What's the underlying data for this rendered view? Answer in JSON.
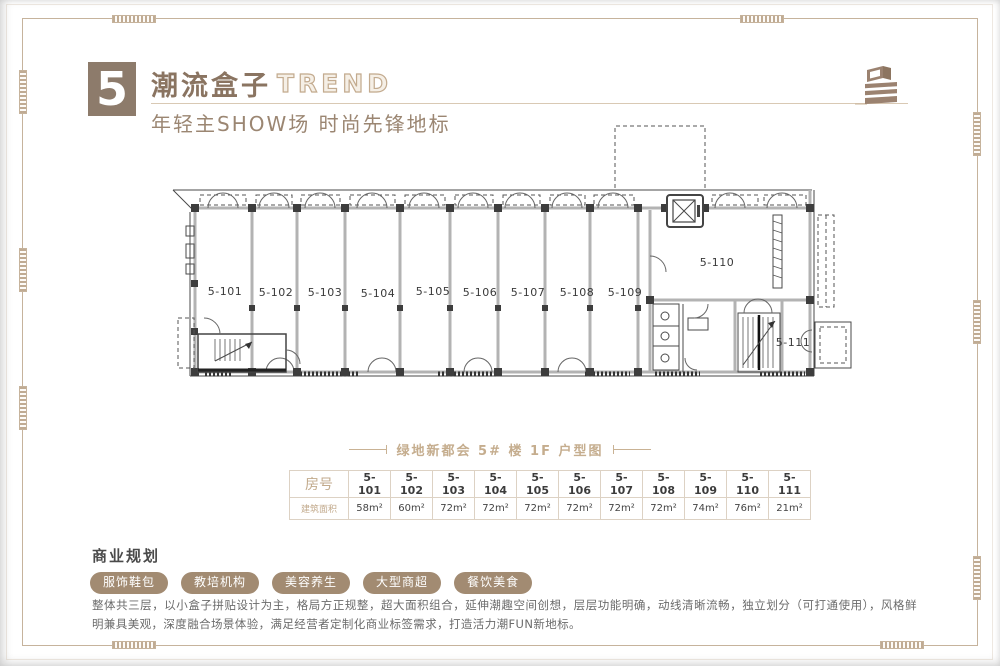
{
  "header": {
    "number": "5",
    "title": "潮流盒子",
    "title_en": "TREND",
    "subtitle": "年轻主SHOW场  时尚先锋地标"
  },
  "plan": {
    "caption": "绿地新都会 5# 楼 1F 户型图",
    "unit_labels": [
      "5-101",
      "5-102",
      "5-103",
      "5-104",
      "5-105",
      "5-106",
      "5-107",
      "5-108",
      "5-109",
      "5-110",
      "5-111"
    ]
  },
  "table": {
    "row1_header": "房号",
    "row2_header": "建筑面积",
    "rooms": [
      "5-101",
      "5-102",
      "5-103",
      "5-104",
      "5-105",
      "5-106",
      "5-107",
      "5-108",
      "5-109",
      "5-110",
      "5-111"
    ],
    "areas": [
      "58m²",
      "60m²",
      "72m²",
      "72m²",
      "72m²",
      "72m²",
      "72m²",
      "72m²",
      "74m²",
      "76m²",
      "21m²"
    ]
  },
  "business": {
    "heading": "商业规划",
    "tags": [
      "服饰鞋包",
      "教培机构",
      "美容养生",
      "大型商超",
      "餐饮美食"
    ],
    "description": "整体共三层，以小盒子拼贴设计为主，格局方正规整，超大面积组合，延伸潮趣空间创想，层层功能明确，动线清晰流畅，独立划分（可打通使用），风格鲜明兼具美观，深度融合场景体验，满足经营者定制化商业标签需求，打造活力潮FUN新地标。"
  },
  "colors": {
    "accent_brown": "#8d7b6b",
    "frame": "#c6b39c",
    "tag_bg": "#a28b72",
    "caption": "#c5ad8e"
  }
}
